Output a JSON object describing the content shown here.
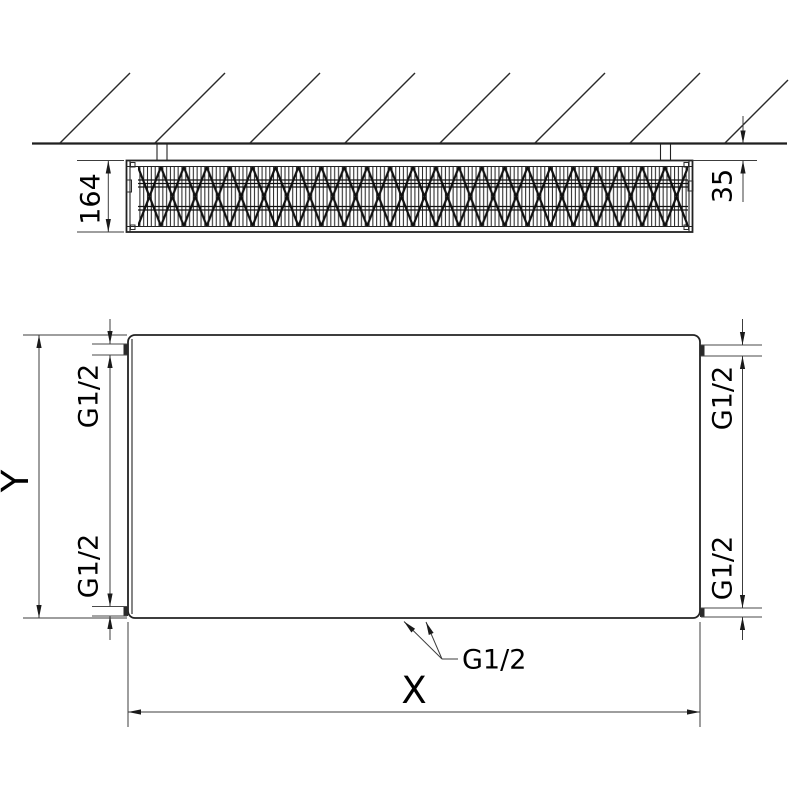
{
  "colors": {
    "line": "#222222",
    "dimension_line": "#3c3c3c",
    "text": "#000000",
    "background": "#ffffff"
  },
  "side_view": {
    "depth_dimension": "164",
    "wall_clearance_dimension": "35"
  },
  "front_view": {
    "height_dimension": "Y",
    "width_dimension": "X",
    "connections": {
      "top_left": "G1/2",
      "top_right": "G1/2",
      "bottom_left": "G1/2",
      "bottom_right": "G1/2",
      "bottom_center": "G1/2"
    }
  }
}
